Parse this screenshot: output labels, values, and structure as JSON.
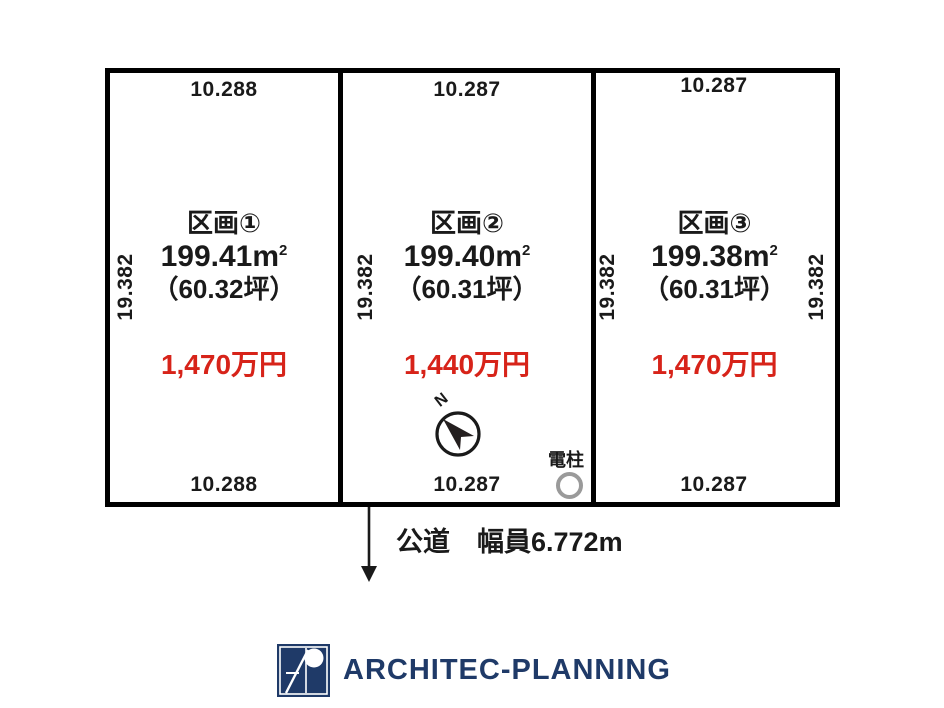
{
  "diagram": {
    "plots": [
      {
        "name": "区画①",
        "area_value": "199.41",
        "area_unit": "m",
        "area_unit_sup": "2",
        "area_tsubo": "（60.32坪）",
        "price": "1,470万円",
        "top_dim": "10.288",
        "bottom_dim": "10.288",
        "side_dim": "19.382"
      },
      {
        "name": "区画②",
        "area_value": "199.40",
        "area_unit": "m",
        "area_unit_sup": "2",
        "area_tsubo": "（60.31坪）",
        "price": "1,440万円",
        "top_dim": "10.287",
        "bottom_dim": "10.287",
        "side_dim": "19.382"
      },
      {
        "name": "区画③",
        "area_value": "199.38",
        "area_unit": "m",
        "area_unit_sup": "2",
        "area_tsubo": "（60.31坪）",
        "price": "1,470万円",
        "top_dim": "10.287",
        "bottom_dim": "10.287",
        "side_dim": "19.382",
        "right_dim": "19.382"
      }
    ],
    "compass": {
      "label": "N"
    },
    "utility_pole": {
      "label": "電柱"
    },
    "road": {
      "label": "公道　幅員6.772m"
    }
  },
  "footer": {
    "logo_text": "ARCHITEC-PLANNING"
  },
  "colors": {
    "price_red": "#d72319",
    "logo_navy": "#1f3a68",
    "pole_gray": "#9a9a9a",
    "line_black": "#000000"
  }
}
